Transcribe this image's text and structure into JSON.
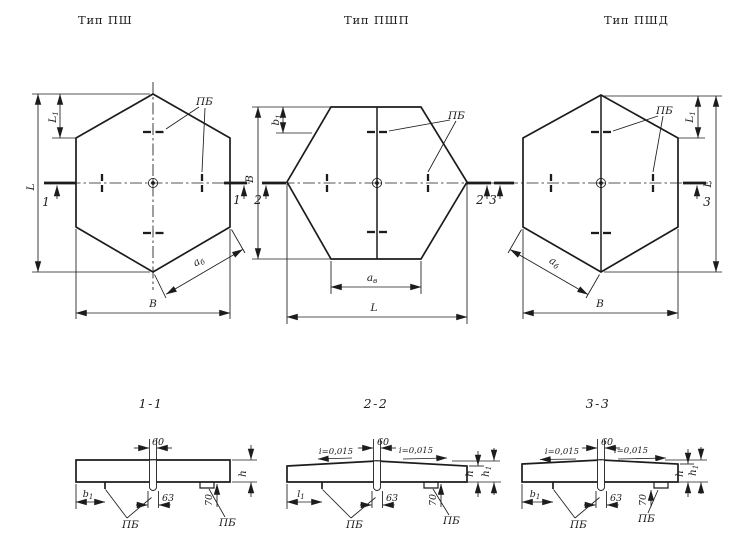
{
  "drawing": {
    "ink_color": "#1c1c1c",
    "paper_color": "#ffffff"
  },
  "plans": [
    {
      "title": "Тип ПШ",
      "loop_label": "ПБ",
      "mark_left": "1",
      "mark_right": "1",
      "dim_L": "L",
      "dim_L1": {
        "base": "L",
        "sub": "1"
      },
      "dim_B": "В",
      "dim_a": {
        "base": "а",
        "sub": "б"
      }
    },
    {
      "title": "Тип ПШП",
      "loop_label": "ПБ",
      "mark_left": "2",
      "mark_right": "2",
      "dim_B": "В",
      "dim_b1": {
        "base": "b",
        "sub": "1"
      },
      "dim_a": {
        "base": "а",
        "sub": "в"
      },
      "dim_L": "L"
    },
    {
      "title": "Тип ПШД",
      "loop_label": "ПБ",
      "mark_left": "3",
      "mark_right": "3",
      "dim_L": "L",
      "dim_L1": {
        "base": "L",
        "sub": "1"
      },
      "dim_B": "В",
      "dim_a": {
        "base": "а",
        "sub": "б"
      }
    }
  ],
  "cross_sections": [
    {
      "title": "1-1",
      "loop_label": "ПБ",
      "dim_top_width": "60",
      "dim_bottom_width": "63",
      "dim_pocket": "70",
      "dim_h": "h",
      "dim_left": {
        "base": "b",
        "sub": "1"
      }
    },
    {
      "title": "2-2",
      "loop_label": "ПБ",
      "slope": "i=0,015",
      "dim_top_width": "60",
      "dim_bottom_width": "63",
      "dim_pocket": "70",
      "dim_h": "h",
      "dim_h1": {
        "base": "h",
        "sub": "1"
      },
      "dim_left": {
        "base": "l",
        "sub": "1"
      }
    },
    {
      "title": "3-3",
      "loop_label": "ПБ",
      "slope": "i=0,015",
      "dim_top_width": "60",
      "dim_bottom_width": "63",
      "dim_pocket": "70",
      "dim_h": "h",
      "dim_h1": {
        "base": "h",
        "sub": "1"
      },
      "dim_left": {
        "base": "b",
        "sub": "1"
      }
    }
  ]
}
